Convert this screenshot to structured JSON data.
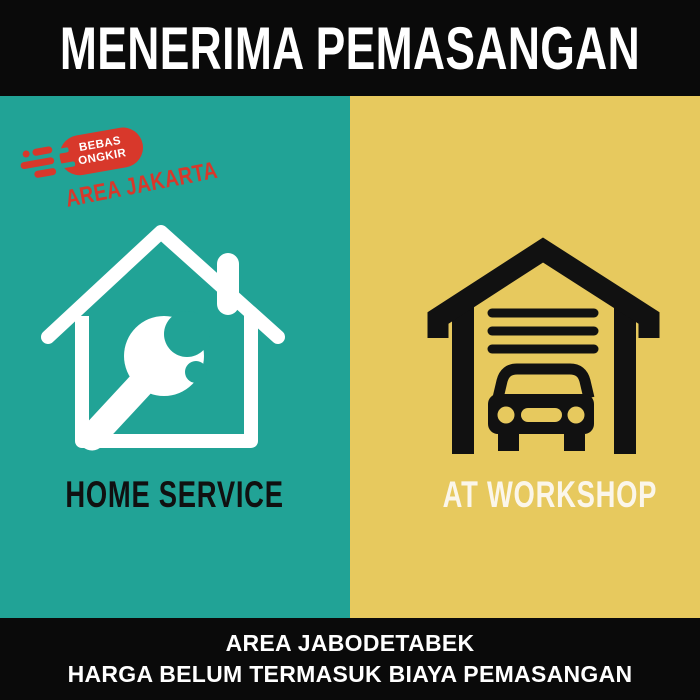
{
  "colors": {
    "teal": "#21A396",
    "yellow": "#E7C95E",
    "black": "#0A0A0A",
    "red": "#D8382B",
    "cream": "#FBF6EA",
    "icon_black": "#111111",
    "icon_white": "#FFFFFF"
  },
  "header": {
    "title": "MENERIMA PEMASANGAN"
  },
  "badge": {
    "line1": "BEBAS",
    "line2": "ONGKIR",
    "subtitle": "AREA JAKARTA",
    "icon": "free-shipping-badge"
  },
  "left_panel": {
    "label": "HOME SERVICE",
    "icon": "house-wrench-icon"
  },
  "right_panel": {
    "label": "AT WORKSHOP",
    "icon": "garage-car-icon"
  },
  "footer": {
    "line1": "AREA JABODETABEK",
    "line2": "HARGA BELUM TERMASUK BIAYA PEMASANGAN"
  }
}
